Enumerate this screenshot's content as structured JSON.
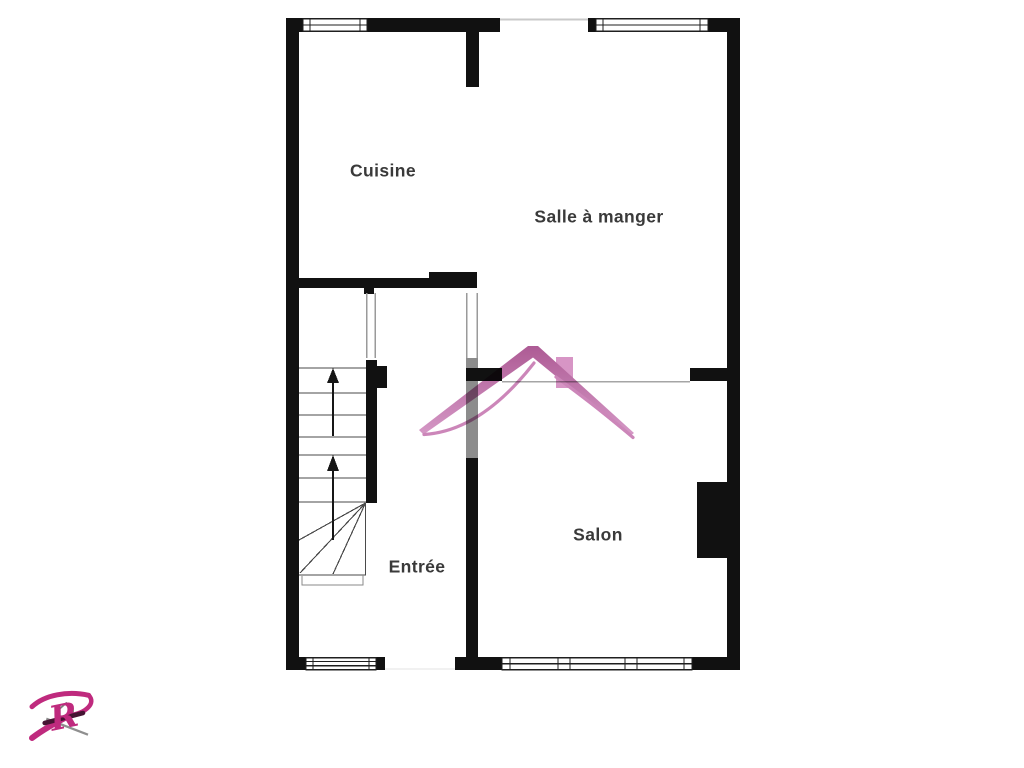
{
  "title": "Plan d'étage",
  "rooms": [
    {
      "id": "cuisine",
      "label": "Cuisine"
    },
    {
      "id": "salle-a-manger",
      "label": "Salle à manger"
    },
    {
      "id": "salon",
      "label": "Salon"
    },
    {
      "id": "entree",
      "label": "Entrée"
    }
  ],
  "stairs": {
    "up_arrows": 2
  },
  "watermark": {
    "icon": "house-roof-icon",
    "roof_color": "#c171a8",
    "chimney_color": "#d58fc2"
  },
  "logo": {
    "letter": "R",
    "color": "#bf2a7e",
    "accent_color": "#8f8f8f"
  },
  "colors": {
    "wall": "#111111",
    "gray_wall": "#8c8c8c",
    "background": "#ffffff",
    "text": "#3a3a3a"
  }
}
